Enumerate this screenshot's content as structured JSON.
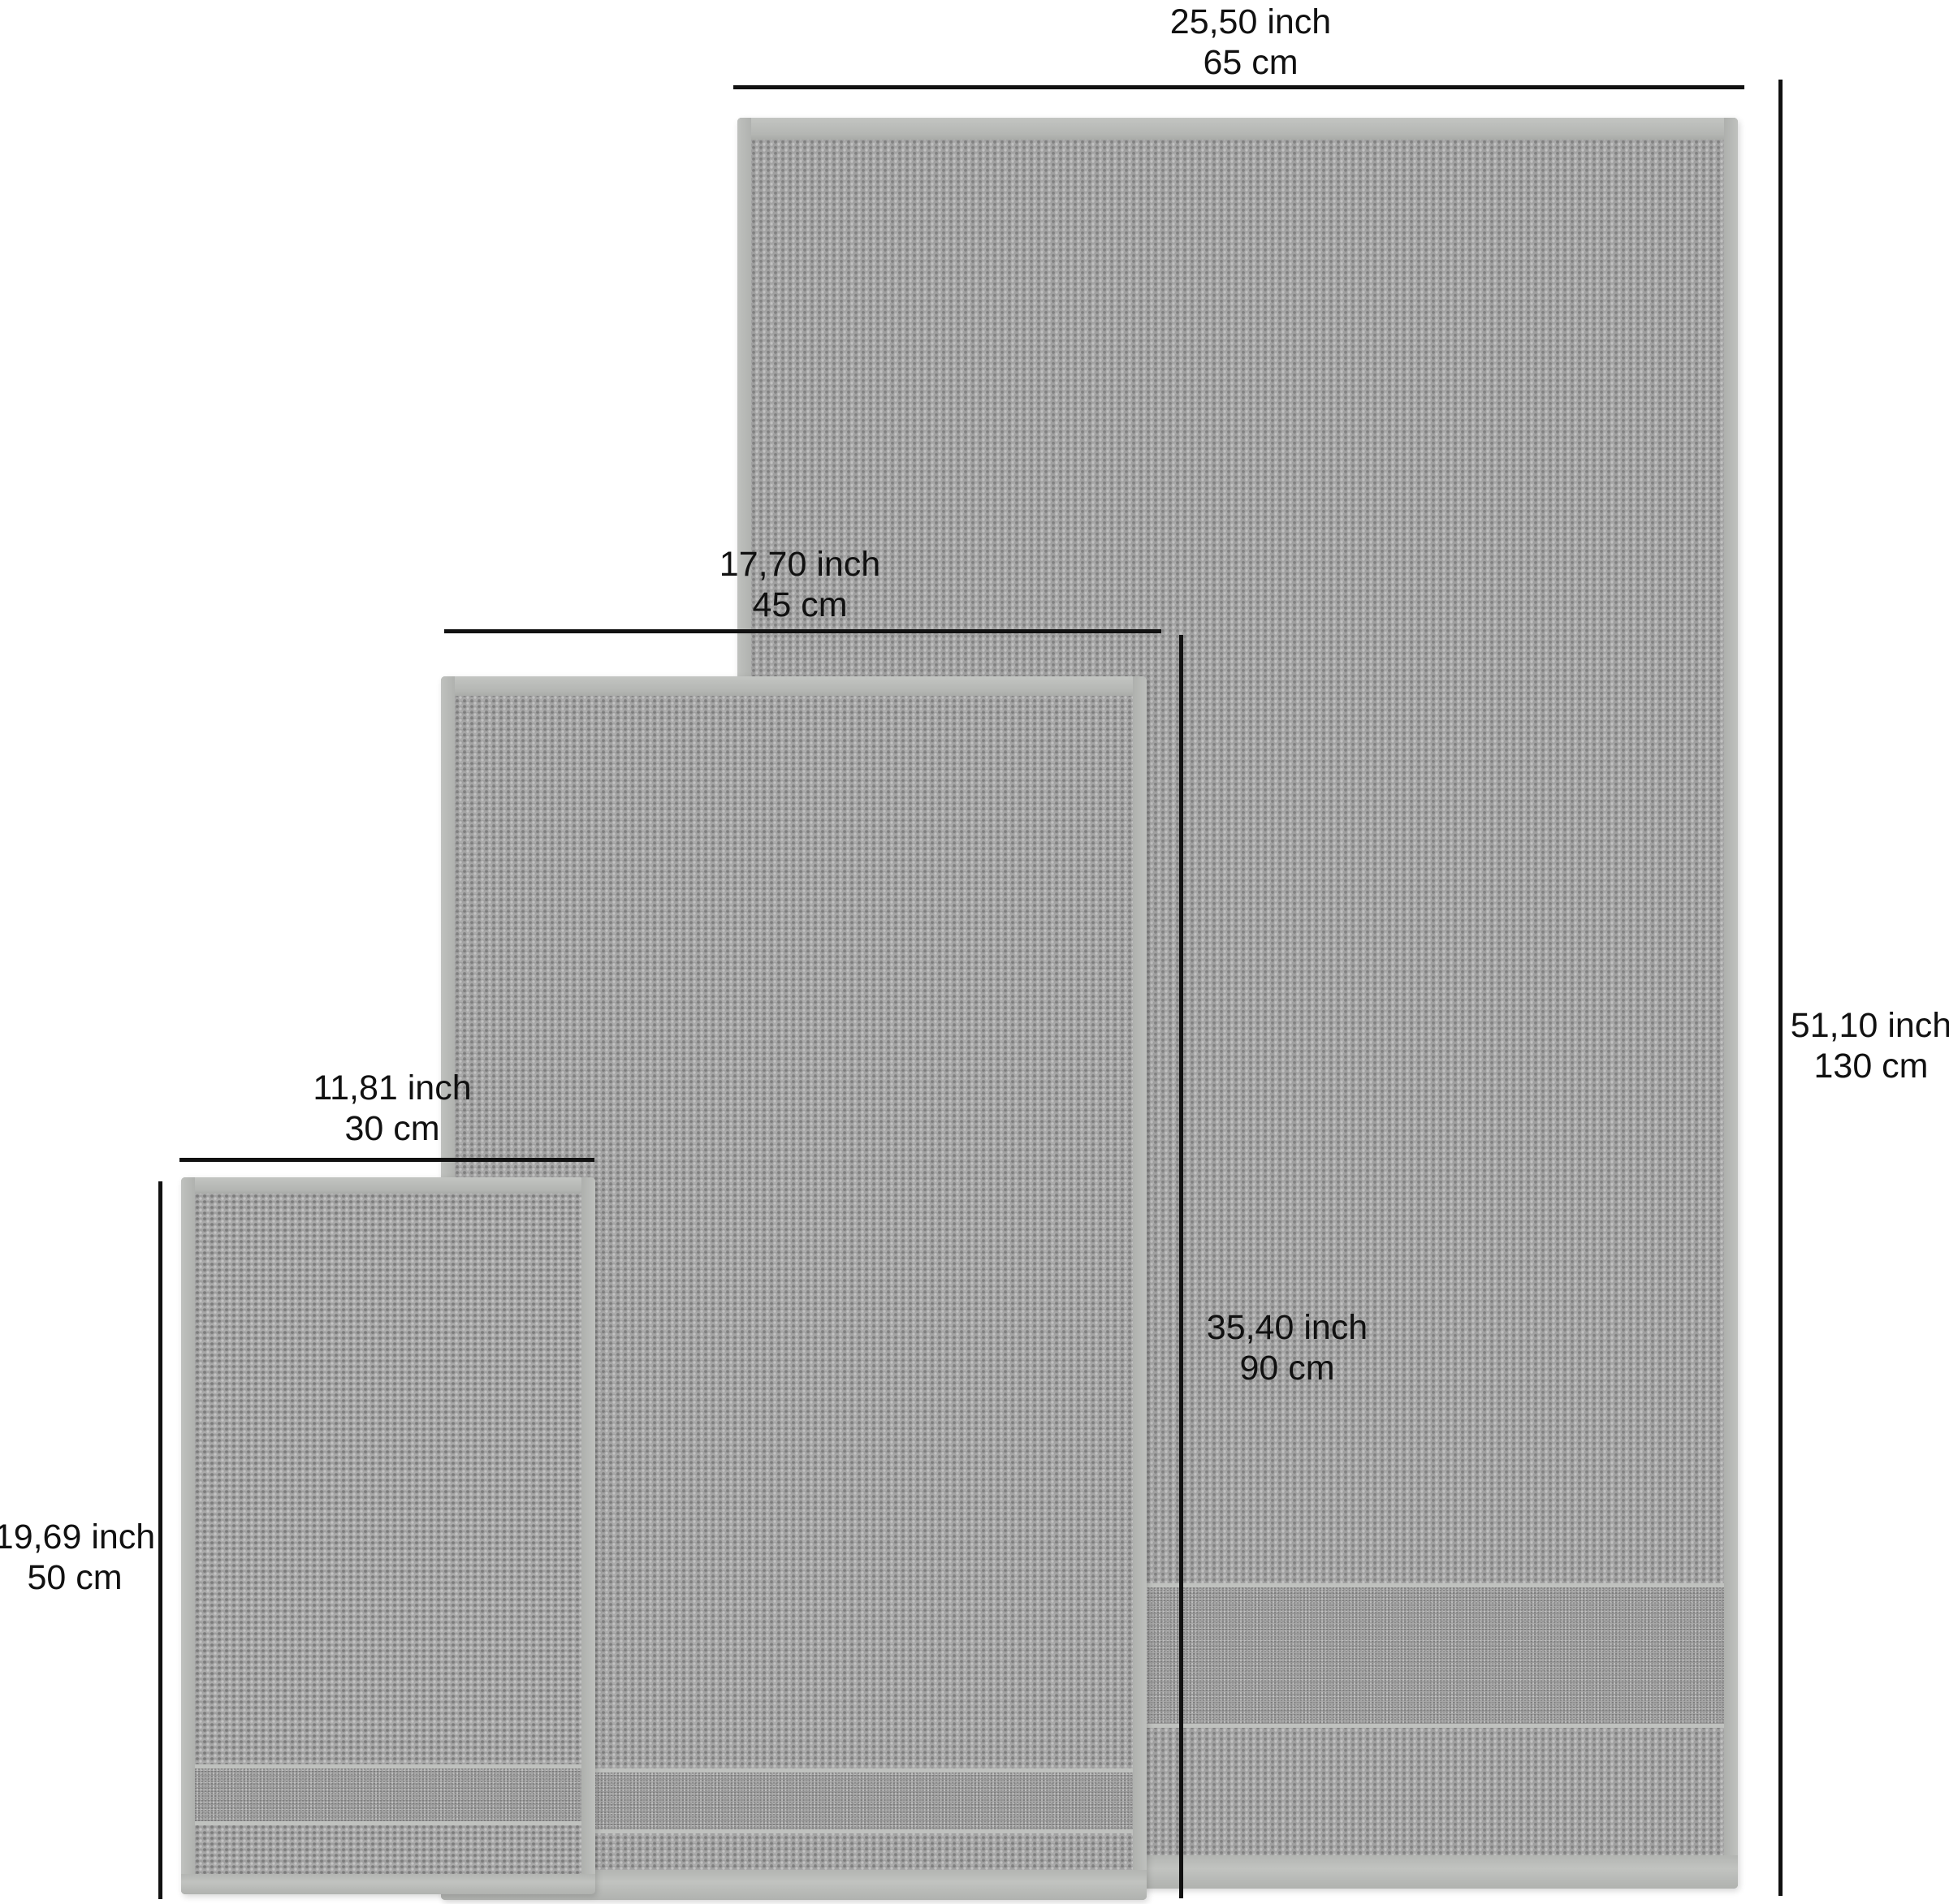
{
  "diagram": {
    "description": "Towel set size diagram with three gray waffle towels and black dimension lines",
    "colors": {
      "background": "#ffffff",
      "dimension_line": "#111111",
      "label_text": "#111111",
      "towel_base": "#a9a9a9",
      "towel_hem": "#c0c2bf"
    },
    "towels": {
      "large": {
        "width_inch": "25,50 inch",
        "width_cm": "65 cm",
        "height_inch": "51,10 inch",
        "height_cm": "130 cm"
      },
      "medium": {
        "width_inch": "17,70 inch",
        "width_cm": "45 cm",
        "height_inch": "35,40 inch",
        "height_cm": "90 cm"
      },
      "small": {
        "width_inch": "11,81 inch",
        "width_cm": "30 cm",
        "height_inch": "19,69 inch",
        "height_cm": "50 cm"
      }
    }
  }
}
